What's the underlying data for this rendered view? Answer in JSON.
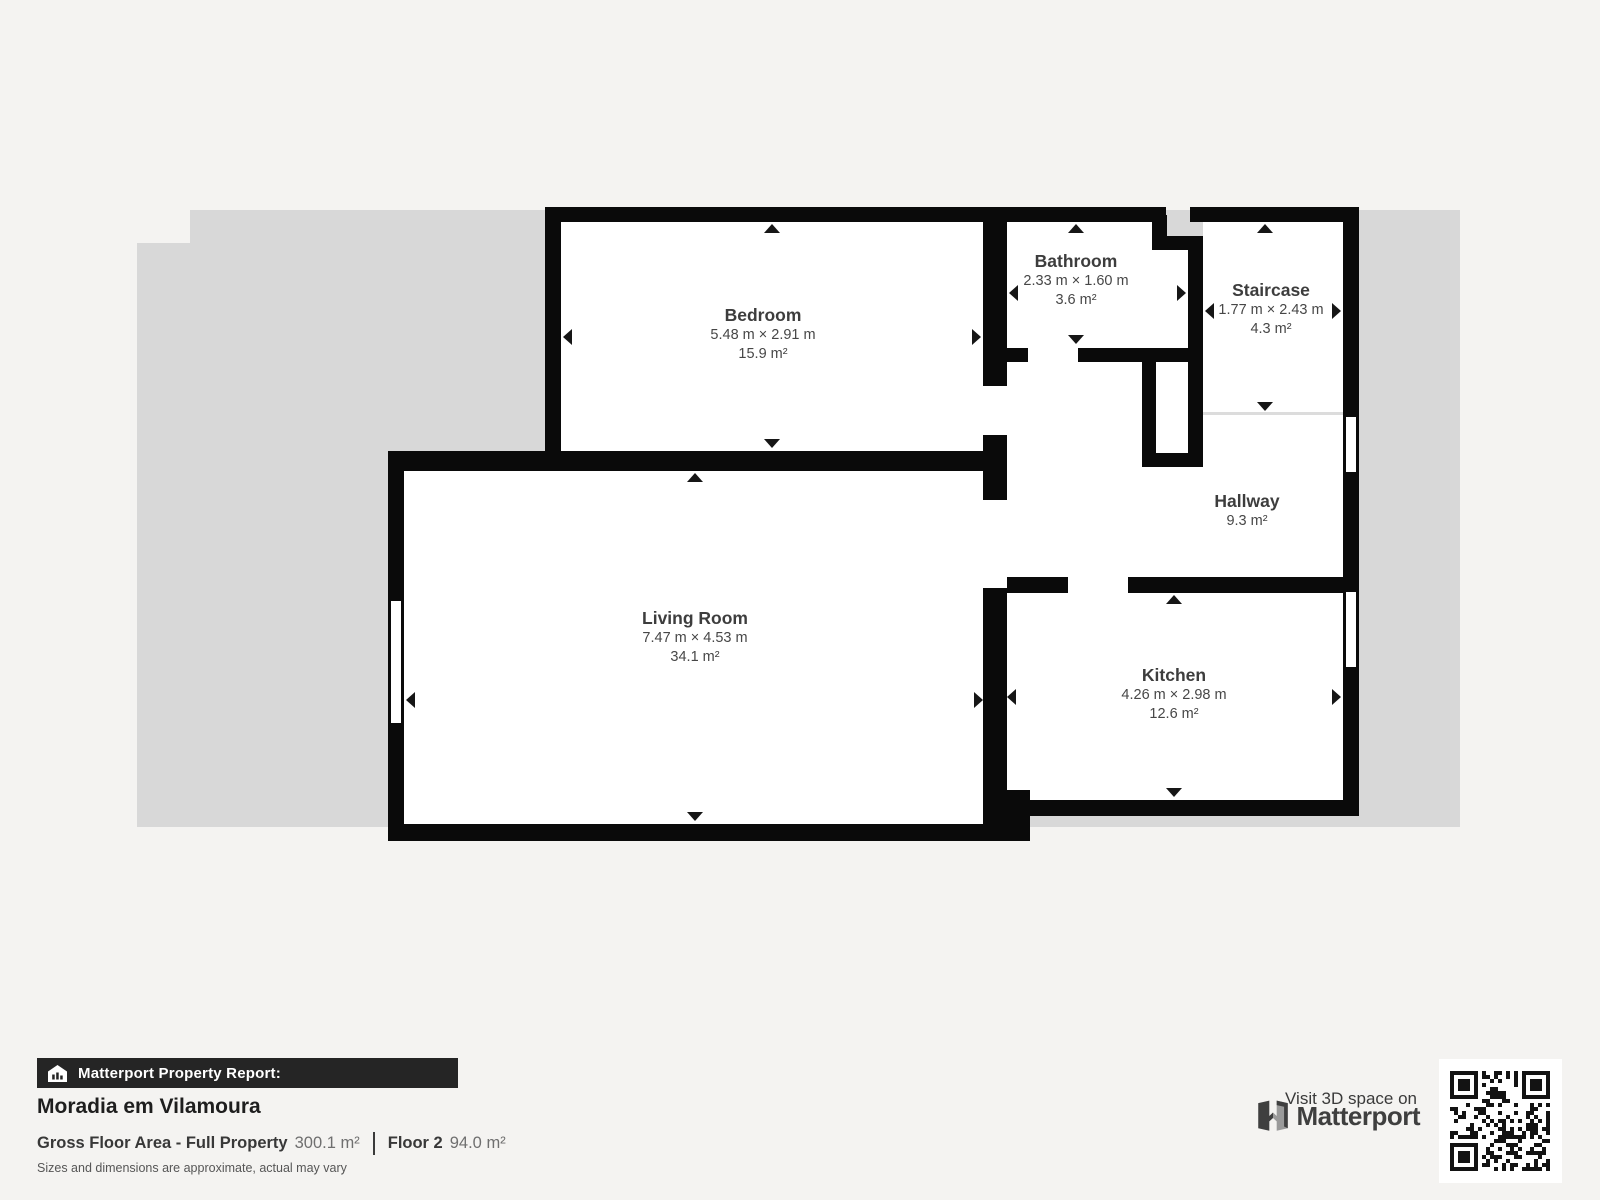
{
  "rooms": {
    "bedroom": {
      "name": "Bedroom",
      "dims": "5.48 m × 2.91 m",
      "area": "15.9 m²"
    },
    "bathroom": {
      "name": "Bathroom",
      "dims": "2.33 m × 1.60 m",
      "area": "3.6 m²"
    },
    "staircase": {
      "name": "Staircase",
      "dims": "1.77 m × 2.43 m",
      "area": "4.3 m²"
    },
    "hallway": {
      "name": "Hallway",
      "area": "9.3 m²"
    },
    "living_room": {
      "name": "Living Room",
      "dims": "7.47 m × 4.53 m",
      "area": "34.1 m²"
    },
    "kitchen": {
      "name": "Kitchen",
      "dims": "4.26 m × 2.98 m",
      "area": "12.6 m²"
    }
  },
  "footer": {
    "report_label": "Matterport Property Report:",
    "property_name": "Moradia em Vilamoura",
    "gross_label": "Gross Floor Area - Full Property",
    "gross_value": "300.1 m²",
    "floor_label": "Floor 2",
    "floor_value": "94.0 m²",
    "disclaimer": "Sizes and dimensions are approximate, actual may vary"
  },
  "branding": {
    "visit_text": "Visit 3D space on",
    "logo_text": "Matterport"
  },
  "colors": {
    "background": "#f4f3f1",
    "floor_silhouette": "#d8d8d8",
    "walls": "#0a0a0a",
    "room_fill": "#ffffff",
    "label_text": "#3d3d3d",
    "report_bar": "#252525"
  }
}
